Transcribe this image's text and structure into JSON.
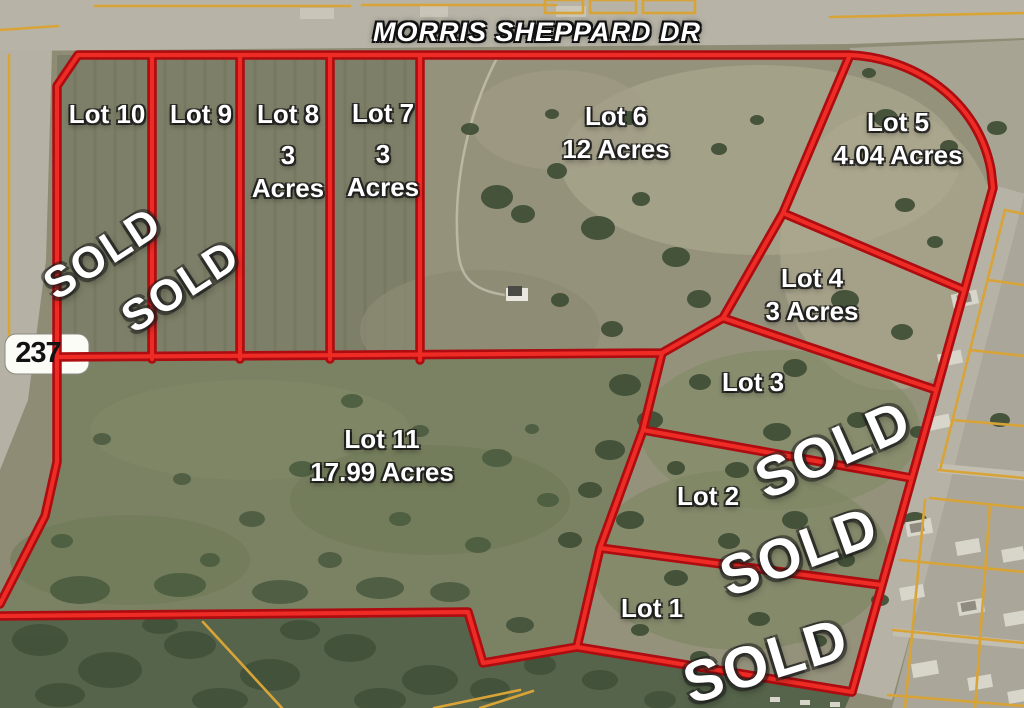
{
  "road": {
    "label": "MORRIS SHEPPARD DR"
  },
  "highway_shield": {
    "number": "237"
  },
  "sold_text": "SOLD",
  "lots": [
    {
      "name": "Lot 10",
      "acreage": "",
      "sold": true,
      "lines": [
        "Lot 10"
      ]
    },
    {
      "name": "Lot 9",
      "acreage": "",
      "sold": true,
      "lines": [
        "Lot 9"
      ]
    },
    {
      "name": "Lot 8",
      "acreage": "3 Acres",
      "sold": false,
      "lines": [
        "Lot 8",
        "3",
        "Acres"
      ]
    },
    {
      "name": "Lot 7",
      "acreage": "3 Acres",
      "sold": false,
      "lines": [
        "Lot 7",
        "3",
        "Acres"
      ]
    },
    {
      "name": "Lot 6",
      "acreage": "12 Acres",
      "sold": false,
      "lines": [
        "Lot 6",
        "12 Acres"
      ]
    },
    {
      "name": "Lot 5",
      "acreage": "4.04 Acres",
      "sold": false,
      "lines": [
        "Lot 5",
        "4.04 Acres"
      ]
    },
    {
      "name": "Lot 4",
      "acreage": "3 Acres",
      "sold": false,
      "lines": [
        "Lot 4",
        "3 Acres"
      ]
    },
    {
      "name": "Lot 3",
      "acreage": "",
      "sold": true,
      "lines": [
        "Lot 3"
      ]
    },
    {
      "name": "Lot 2",
      "acreage": "",
      "sold": true,
      "lines": [
        "Lot 2"
      ]
    },
    {
      "name": "Lot 1",
      "acreage": "",
      "sold": true,
      "lines": [
        "Lot 1"
      ]
    },
    {
      "name": "Lot 11",
      "acreage": "17.99 Acres",
      "sold": false,
      "lines": [
        "Lot 11",
        "17.99 Acres"
      ]
    }
  ],
  "colors": {
    "boundary_red": "#ee2b24",
    "boundary_red_dark": "#ad0c10",
    "parcel_yellow": "#d9a437",
    "label_text": "#ffffff",
    "shield_background": "#fcfcf7",
    "shield_text": "#121212"
  }
}
